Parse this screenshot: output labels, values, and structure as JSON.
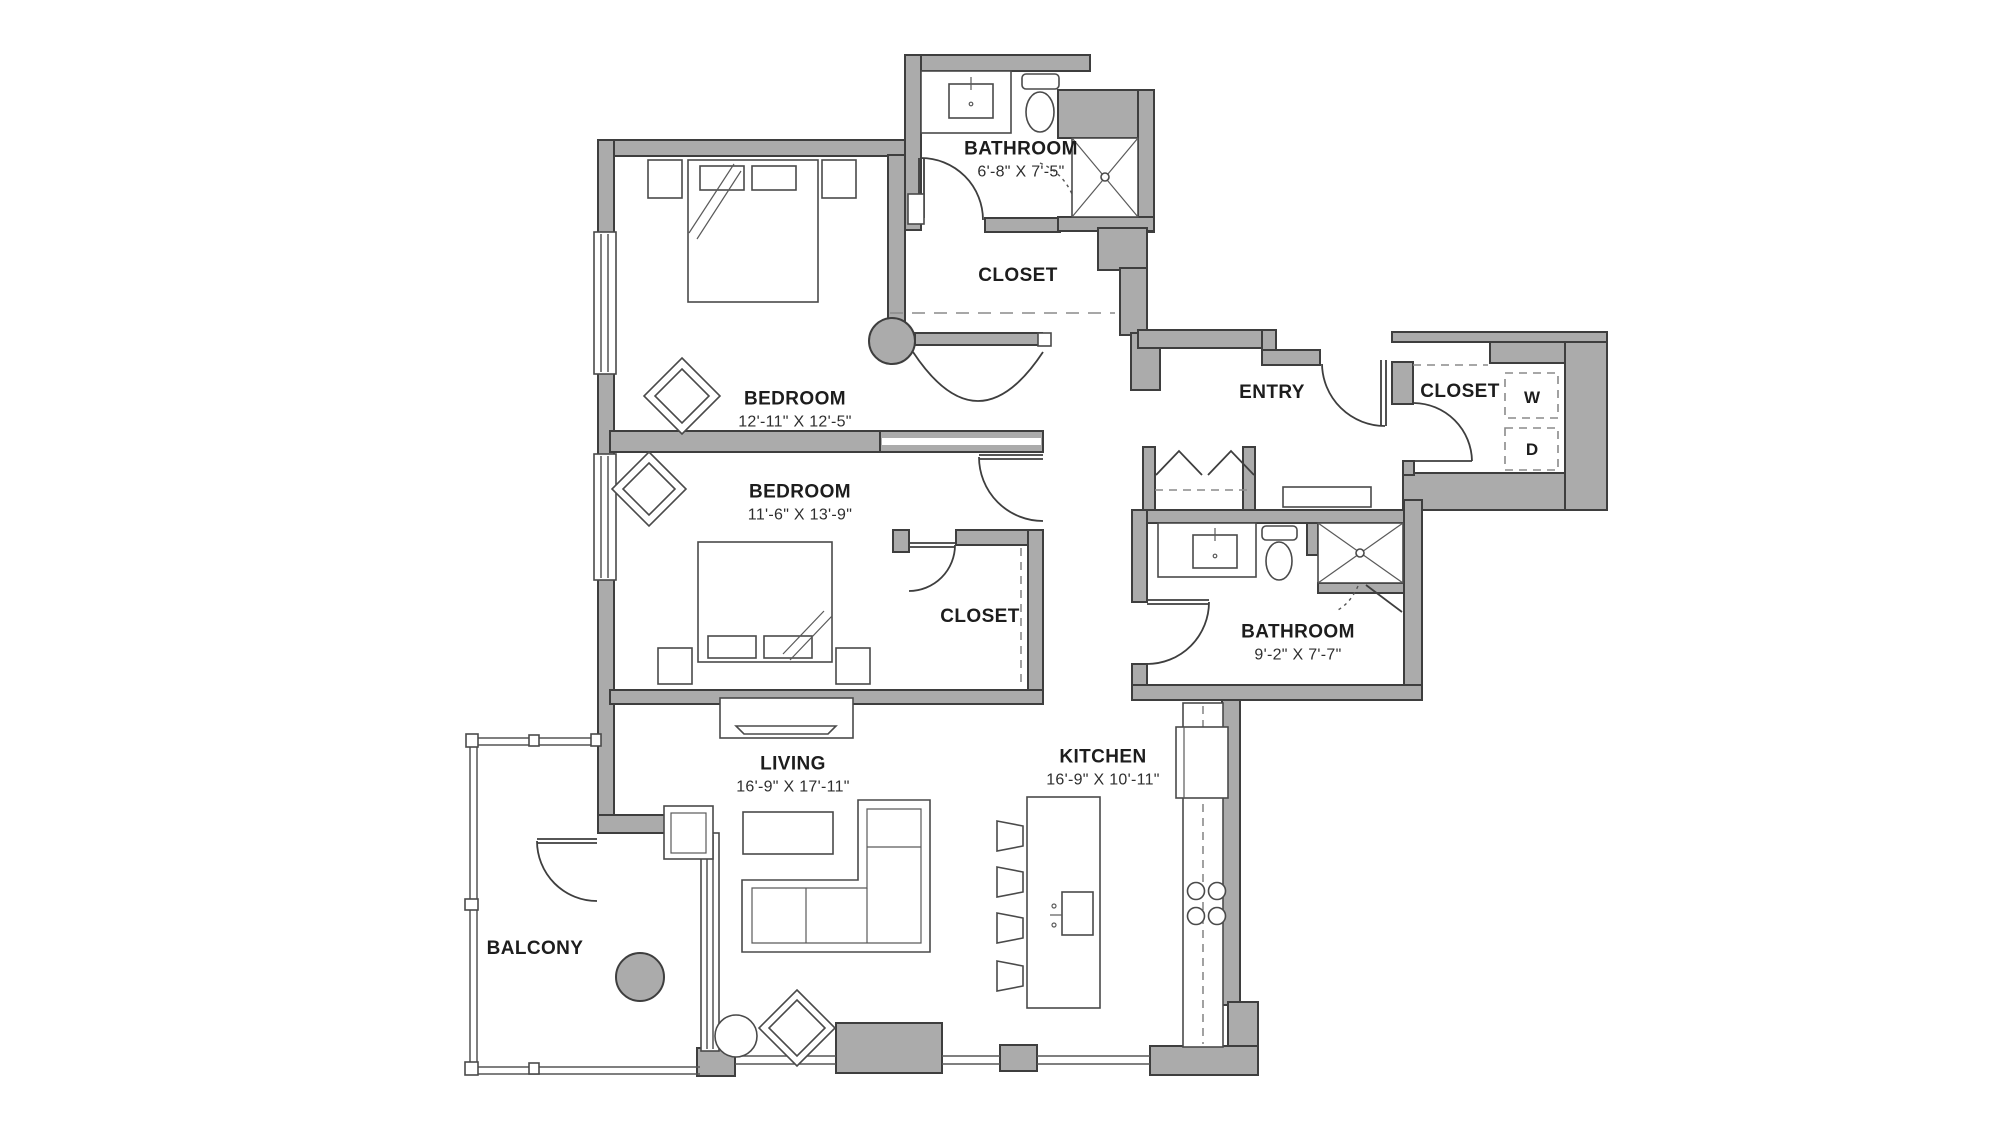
{
  "floorplan": {
    "rooms": [
      {
        "id": "bathroom-1",
        "name": "BATHROOM",
        "dims": "6'-8\" X 7'-5\""
      },
      {
        "id": "closet-walkin",
        "name": "CLOSET",
        "dims": ""
      },
      {
        "id": "bedroom-1",
        "name": "BEDROOM",
        "dims": "12'-11\" X 12'-5\""
      },
      {
        "id": "bedroom-2",
        "name": "BEDROOM",
        "dims": "11'-6\" X 13'-9\""
      },
      {
        "id": "entry",
        "name": "ENTRY",
        "dims": ""
      },
      {
        "id": "closet-wd",
        "name": "CLOSET",
        "dims": ""
      },
      {
        "id": "closet-2",
        "name": "CLOSET",
        "dims": ""
      },
      {
        "id": "bathroom-2",
        "name": "BATHROOM",
        "dims": "9'-2\" X 7'-7\""
      },
      {
        "id": "living",
        "name": "LIVING",
        "dims": "16'-9\" X 17'-11\""
      },
      {
        "id": "kitchen",
        "name": "KITCHEN",
        "dims": "16'-9\" X 10'-11\""
      },
      {
        "id": "balcony",
        "name": "BALCONY",
        "dims": ""
      }
    ],
    "appliances": {
      "washer": "W",
      "dryer": "D"
    },
    "colors": {
      "wall": "#ababab",
      "line": "#3e3e3e",
      "text": "#1d1d1d"
    }
  }
}
